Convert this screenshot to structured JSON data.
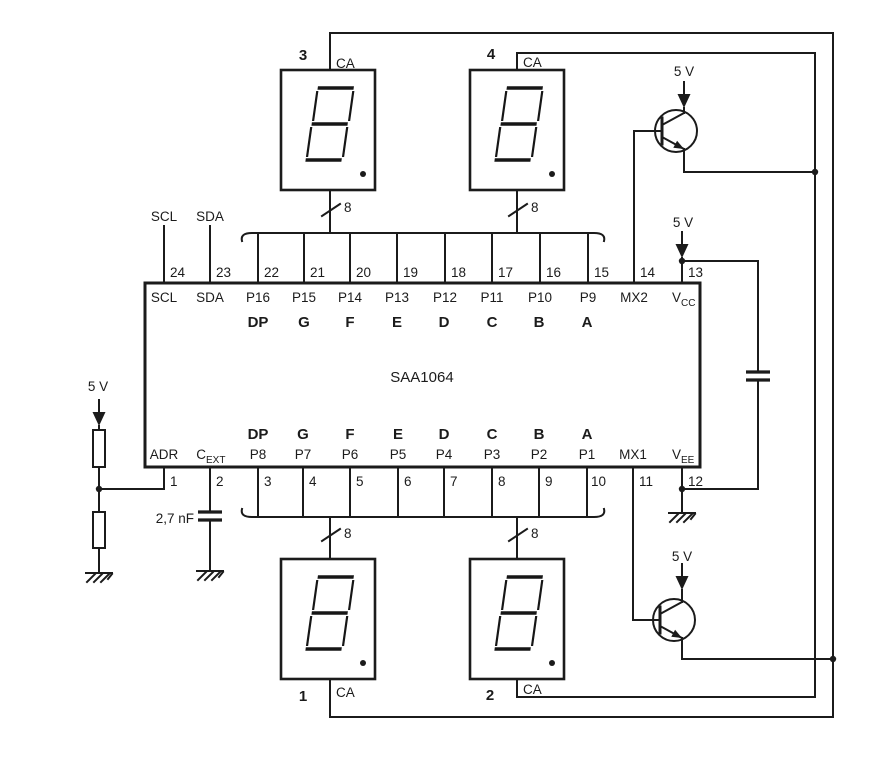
{
  "diagram": {
    "ic_name": "SAA1064",
    "external_labels": {
      "scl": "SCL",
      "sda": "SDA"
    },
    "supply_label": "5 V",
    "cext_value": "2,7 nF",
    "bus_width_label": "8",
    "ca_label": "CA",
    "segment_letters": [
      "DP",
      "G",
      "F",
      "E",
      "D",
      "C",
      "B",
      "A"
    ],
    "displays": [
      {
        "number": "3"
      },
      {
        "number": "4"
      },
      {
        "number": "1"
      },
      {
        "number": "2"
      }
    ],
    "top_pins": [
      {
        "num": "24",
        "label": "SCL"
      },
      {
        "num": "23",
        "label": "SDA"
      },
      {
        "num": "22",
        "label": "P16"
      },
      {
        "num": "21",
        "label": "P15"
      },
      {
        "num": "20",
        "label": "P14"
      },
      {
        "num": "19",
        "label": "P13"
      },
      {
        "num": "18",
        "label": "P12"
      },
      {
        "num": "17",
        "label": "P11"
      },
      {
        "num": "16",
        "label": "P10"
      },
      {
        "num": "15",
        "label": "P9"
      },
      {
        "num": "14",
        "label": "MX2"
      },
      {
        "num": "13",
        "label": "V",
        "sub": "CC"
      }
    ],
    "bottom_pins": [
      {
        "num": "1",
        "label": "ADR"
      },
      {
        "num": "2",
        "label": "C",
        "sub": "EXT"
      },
      {
        "num": "3",
        "label": "P8"
      },
      {
        "num": "4",
        "label": "P7"
      },
      {
        "num": "5",
        "label": "P6"
      },
      {
        "num": "6",
        "label": "P5"
      },
      {
        "num": "7",
        "label": "P4"
      },
      {
        "num": "8",
        "label": "P3"
      },
      {
        "num": "9",
        "label": "P2"
      },
      {
        "num": "10",
        "label": "P1"
      },
      {
        "num": "11",
        "label": "MX1"
      },
      {
        "num": "12",
        "label": "V",
        "sub": "EE"
      }
    ],
    "colors": {
      "ink": "#1b1b1b",
      "segment_red": "#e8261d",
      "background": "#ffffff"
    }
  }
}
